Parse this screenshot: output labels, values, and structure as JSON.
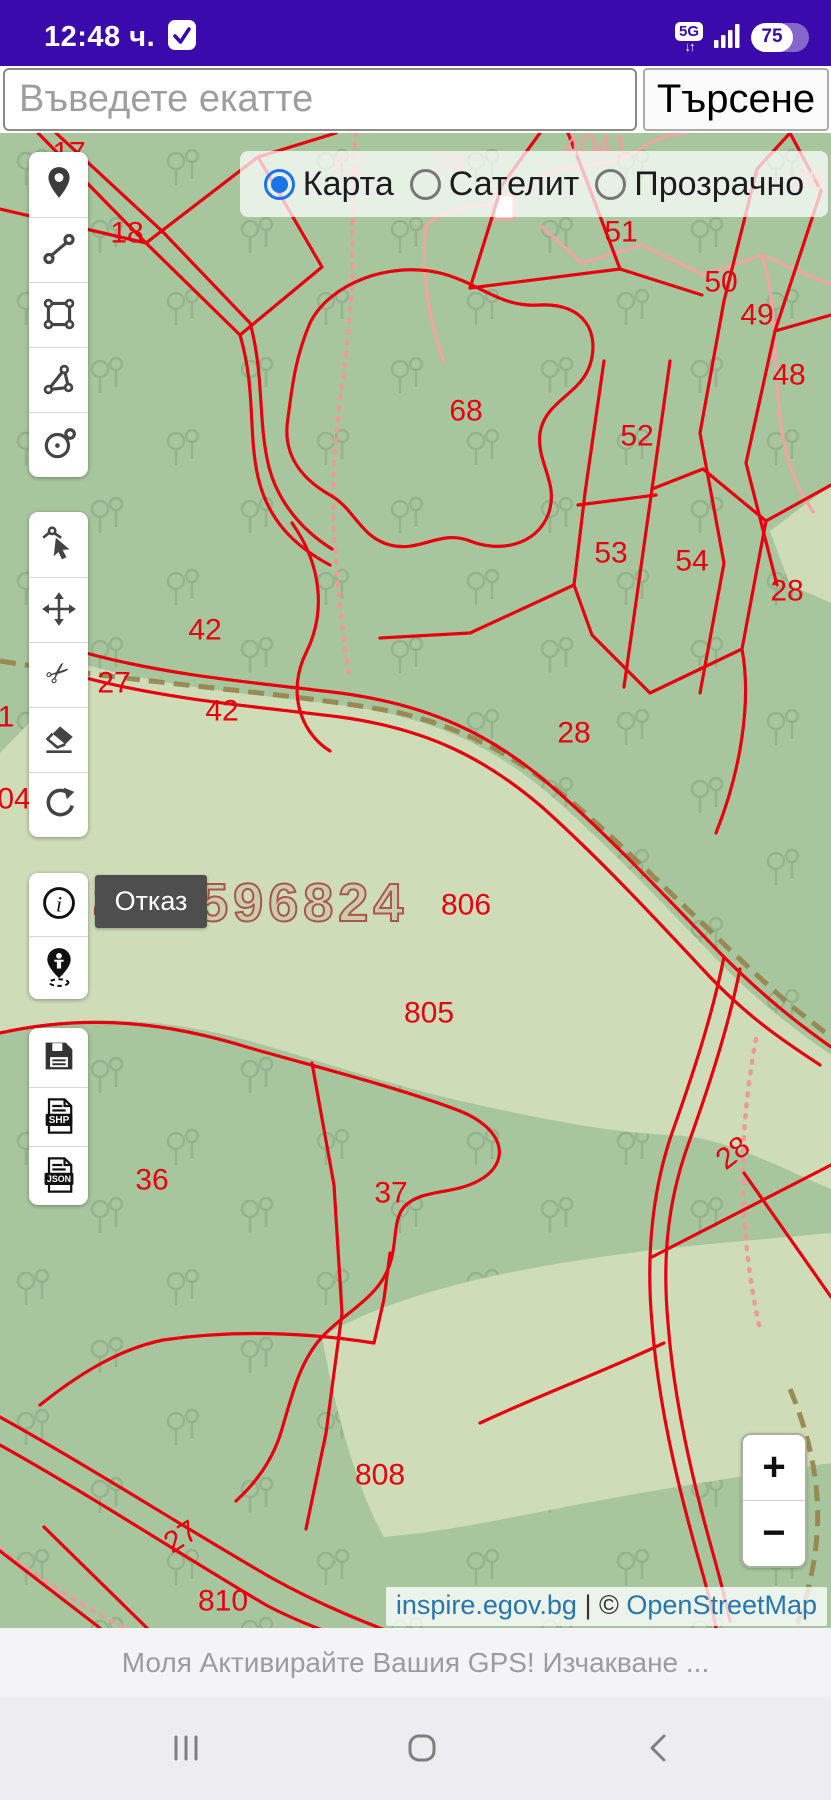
{
  "status_bar": {
    "time": "12:48 ч.",
    "network": "5G",
    "battery_percent": "75"
  },
  "search": {
    "placeholder": "Въведете екатте",
    "button_label": "Търсене"
  },
  "layer_switcher": {
    "options": [
      {
        "label": "Карта",
        "selected": true
      },
      {
        "label": "Сателит",
        "selected": false
      },
      {
        "label": "Прозрачно",
        "selected": false
      }
    ]
  },
  "toolbar": {
    "groups": [
      {
        "name": "draw",
        "tools": [
          "place-marker",
          "draw-line",
          "draw-rectangle",
          "draw-polygon",
          "draw-circle"
        ]
      },
      {
        "name": "edit",
        "tools": [
          "modify-feature",
          "move-feature",
          "cut-feature",
          "erase-feature",
          "rotate-feature"
        ]
      },
      {
        "name": "info",
        "tools": [
          "feature-info",
          "gps-locate"
        ]
      },
      {
        "name": "export",
        "tools": [
          "save",
          "export-shp",
          "export-json"
        ]
      }
    ],
    "file_labels": {
      "shp": "SHP",
      "json": "JSON"
    }
  },
  "cancel_button": {
    "label": "Отказ"
  },
  "watermark": {
    "text": "0878596824"
  },
  "zoom_control": {
    "plus": "+",
    "minus": "−"
  },
  "attribution": {
    "site": "inspire.egov.bg",
    "separator": " | ",
    "copyright_symbol": "© ",
    "osm": "OpenStreetMap"
  },
  "gps_message": "Моля Активирайте Вашия GPS! Изчакване ...",
  "icons": {
    "time-check": "check-in-rounded-square",
    "network": "5G-badge-with-up-down-arrows",
    "signal": "signal-bars",
    "battery": "pill-with-percent",
    "nav": [
      "recents-bars",
      "home-rounded-square",
      "back-chevron"
    ]
  },
  "map": {
    "label_colors": {
      "red": "#e8000f",
      "pink": "#ef9fa0"
    },
    "labels": [
      {
        "t": "17",
        "x": 69,
        "y": 20
      },
      {
        "t": "18",
        "x": 127,
        "y": 100
      },
      {
        "t": "62",
        "x": 350,
        "y": 32,
        "c": "pink"
      },
      {
        "t": "39",
        "x": 448,
        "y": 30,
        "c": "pink"
      },
      {
        "t": "40",
        "x": 580,
        "y": 13,
        "c": "pink"
      },
      {
        "t": "41",
        "x": 612,
        "y": 13,
        "c": "pink"
      },
      {
        "t": "46",
        "x": 808,
        "y": 47,
        "c": "pink"
      },
      {
        "t": "51",
        "x": 621,
        "y": 99
      },
      {
        "t": "50",
        "x": 721,
        "y": 149
      },
      {
        "t": "49",
        "x": 757,
        "y": 182
      },
      {
        "t": "48",
        "x": 789,
        "y": 242
      },
      {
        "t": "68",
        "x": 466,
        "y": 278
      },
      {
        "t": "52",
        "x": 637,
        "y": 303
      },
      {
        "t": "53",
        "x": 611,
        "y": 420
      },
      {
        "t": "54",
        "x": 692,
        "y": 428
      },
      {
        "t": "28",
        "x": 787,
        "y": 458
      },
      {
        "t": "42",
        "x": 205,
        "y": 497
      },
      {
        "t": "27",
        "x": 114,
        "y": 550
      },
      {
        "t": "42",
        "x": 222,
        "y": 578
      },
      {
        "t": "28",
        "x": 574,
        "y": 600
      },
      {
        "t": "1",
        "x": 6,
        "y": 584
      },
      {
        "t": "04",
        "x": 14,
        "y": 666
      },
      {
        "t": "806",
        "x": 466,
        "y": 772
      },
      {
        "t": "805",
        "x": 429,
        "y": 880
      },
      {
        "t": "36",
        "x": 152,
        "y": 1047
      },
      {
        "t": "37",
        "x": 391,
        "y": 1060
      },
      {
        "t": "28",
        "x": 733,
        "y": 1020,
        "r": -38
      },
      {
        "t": "808",
        "x": 380,
        "y": 1342
      },
      {
        "t": "27",
        "x": 181,
        "y": 1404,
        "r": -32
      },
      {
        "t": "810",
        "x": 223,
        "y": 1468
      }
    ]
  }
}
